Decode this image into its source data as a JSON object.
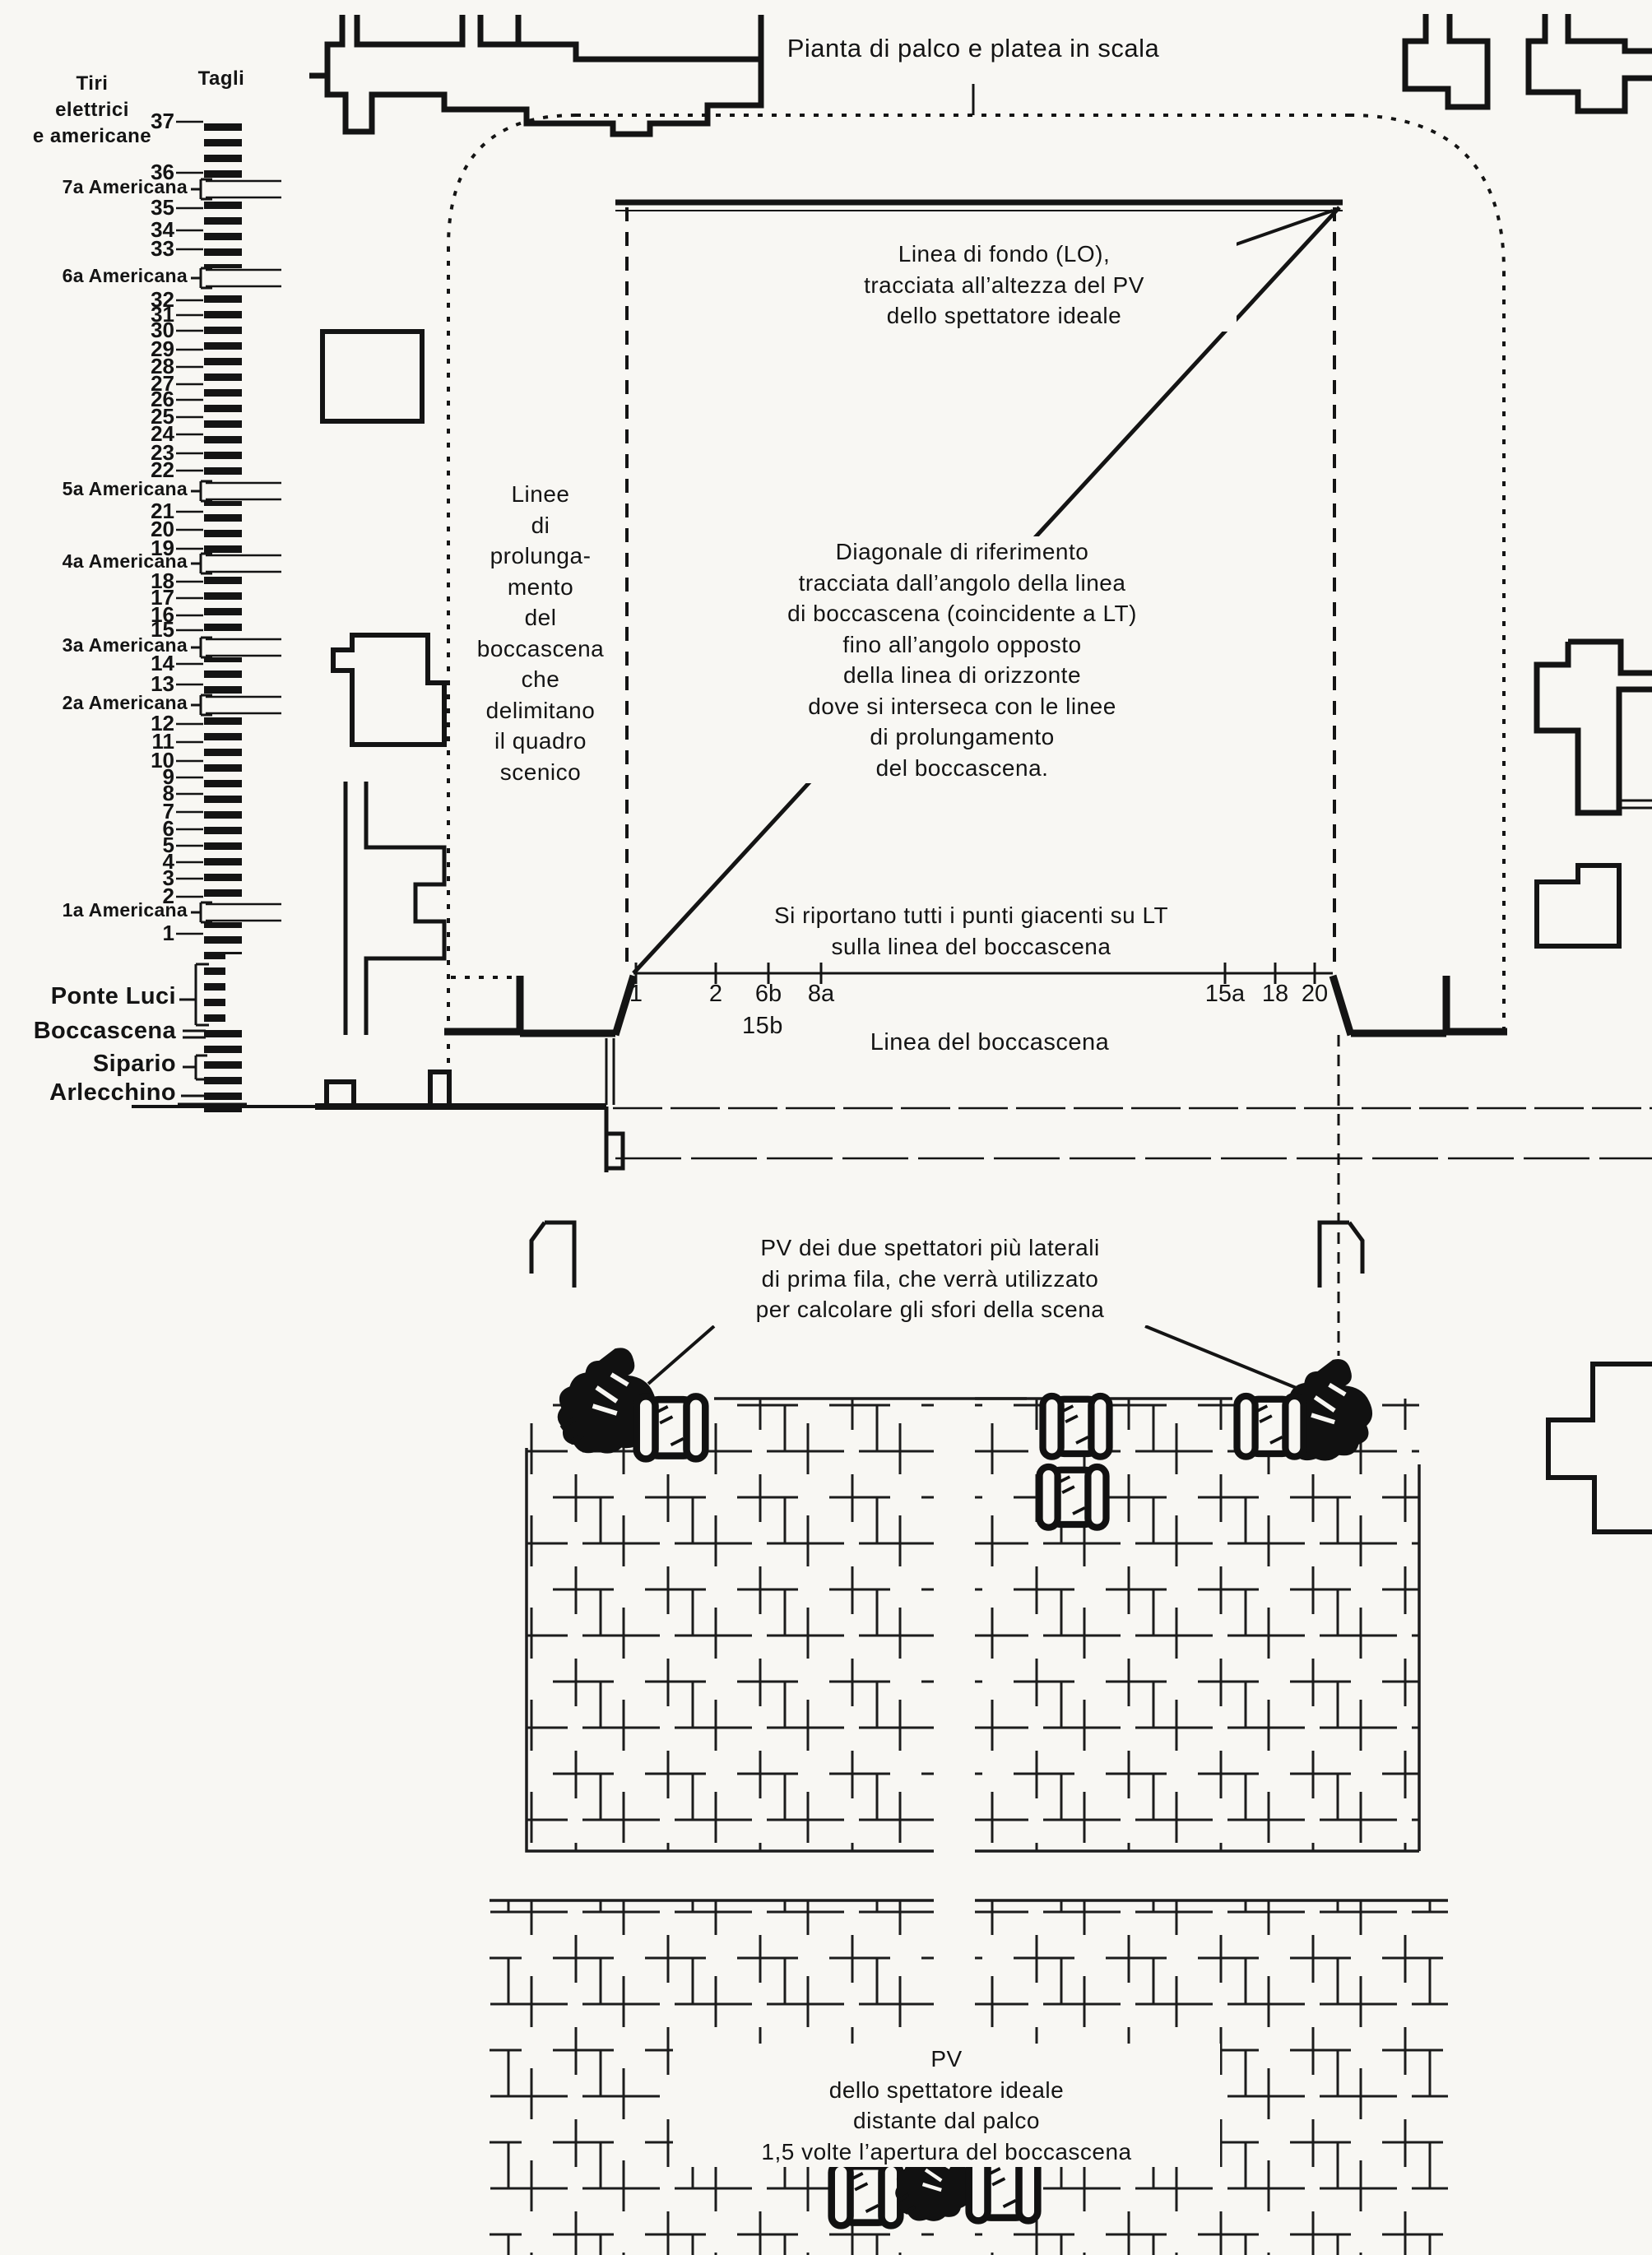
{
  "title": "Pianta di palco e platea in scala",
  "fly_system": {
    "header_left": "Tiri\nelettrici\ne americane",
    "header_right": "Tagli",
    "rows": [
      {
        "label": "37"
      },
      {
        "label": "36"
      },
      {
        "label": "7a Americana"
      },
      {
        "label": "35"
      },
      {
        "label": "34"
      },
      {
        "label": "33"
      },
      {
        "label": "6a Americana"
      },
      {
        "label": "32"
      },
      {
        "label": "31"
      },
      {
        "label": "30"
      },
      {
        "label": "29"
      },
      {
        "label": "28"
      },
      {
        "label": "27"
      },
      {
        "label": "26"
      },
      {
        "label": "25"
      },
      {
        "label": "24"
      },
      {
        "label": "23"
      },
      {
        "label": "22"
      },
      {
        "label": "5a Americana"
      },
      {
        "label": "21"
      },
      {
        "label": "20"
      },
      {
        "label": "19"
      },
      {
        "label": "4a Americana"
      },
      {
        "label": "18"
      },
      {
        "label": "17"
      },
      {
        "label": "16"
      },
      {
        "label": "15"
      },
      {
        "label": "3a Americana"
      },
      {
        "label": "14"
      },
      {
        "label": "13"
      },
      {
        "label": "2a Americana"
      },
      {
        "label": "12"
      },
      {
        "label": "11"
      },
      {
        "label": "10"
      },
      {
        "label": "9"
      },
      {
        "label": "8"
      },
      {
        "label": "7"
      },
      {
        "label": "6"
      },
      {
        "label": "5"
      },
      {
        "label": "4"
      },
      {
        "label": "3"
      },
      {
        "label": "2"
      },
      {
        "label": "1a Americana"
      },
      {
        "label": "1"
      },
      {
        "label": "Ponte Luci"
      },
      {
        "label": "Boccascena"
      },
      {
        "label": "Sipario"
      },
      {
        "label": "Arlecchino"
      }
    ]
  },
  "stage": {
    "note_fondo": "Linea di fondo (LO),\ntracciata all’altezza del PV\ndello spettatore ideale",
    "note_prolungamento": "Linee\ndi\nprolunga-\nmento\ndel\nboccascena\nche\ndelimitano\nil quadro\nscenico",
    "note_diagonale": "Diagonale di riferimento\ntracciata dall’angolo della linea\ndi boccascena (coincidente a LT)\nfino all’angolo opposto\ndella linea di orizzonte\ndove si interseca con le linee\ndi prolungamento\ndel boccascena.",
    "note_riporto": "Si riportano tutti i punti giacenti su LT\nsulla linea del boccascena",
    "boccascena_label": "Linea del boccascena",
    "lt_ticks": [
      "1",
      "2",
      "6b",
      "8a",
      "15a",
      "18",
      "20"
    ],
    "lt_tick_below": "15b"
  },
  "platea": {
    "note_lateral_pv": "PV dei due spettatori più laterali\ndi prima fila, che verrà utilizzato\nper calcolare gli sfori della scena",
    "note_ideal_pv": "PV\ndello spettatore ideale\ndistante dal palco\n1,5 volte l’apertura del boccascena"
  },
  "colors": {
    "ink": "#141414",
    "paper": "#f8f7f3"
  }
}
